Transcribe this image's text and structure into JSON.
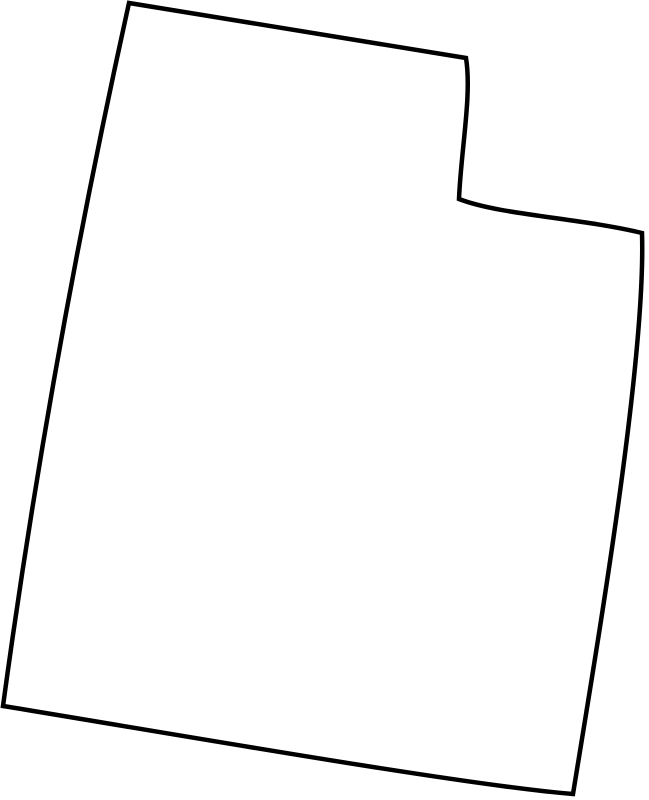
{
  "map": {
    "shape_name": "utah-state-outline",
    "description": "Blank black outline map of the state of Utah, slightly rotated clockwise, unfilled on a white background",
    "stroke_color": "#000000",
    "fill_color": "#ffffff",
    "background_color": "#ffffff",
    "stroke_width_px": 4.5,
    "viewbox": "0 0 649 800",
    "outline_path": "M 129 3 L 466 58 C 472 95 461 150 459 199 C 500 215 580 218 642 233 C 646 360 598 640 573 794 C 470 786 180 735 3 706 Q 50 360 129 3 Z"
  }
}
